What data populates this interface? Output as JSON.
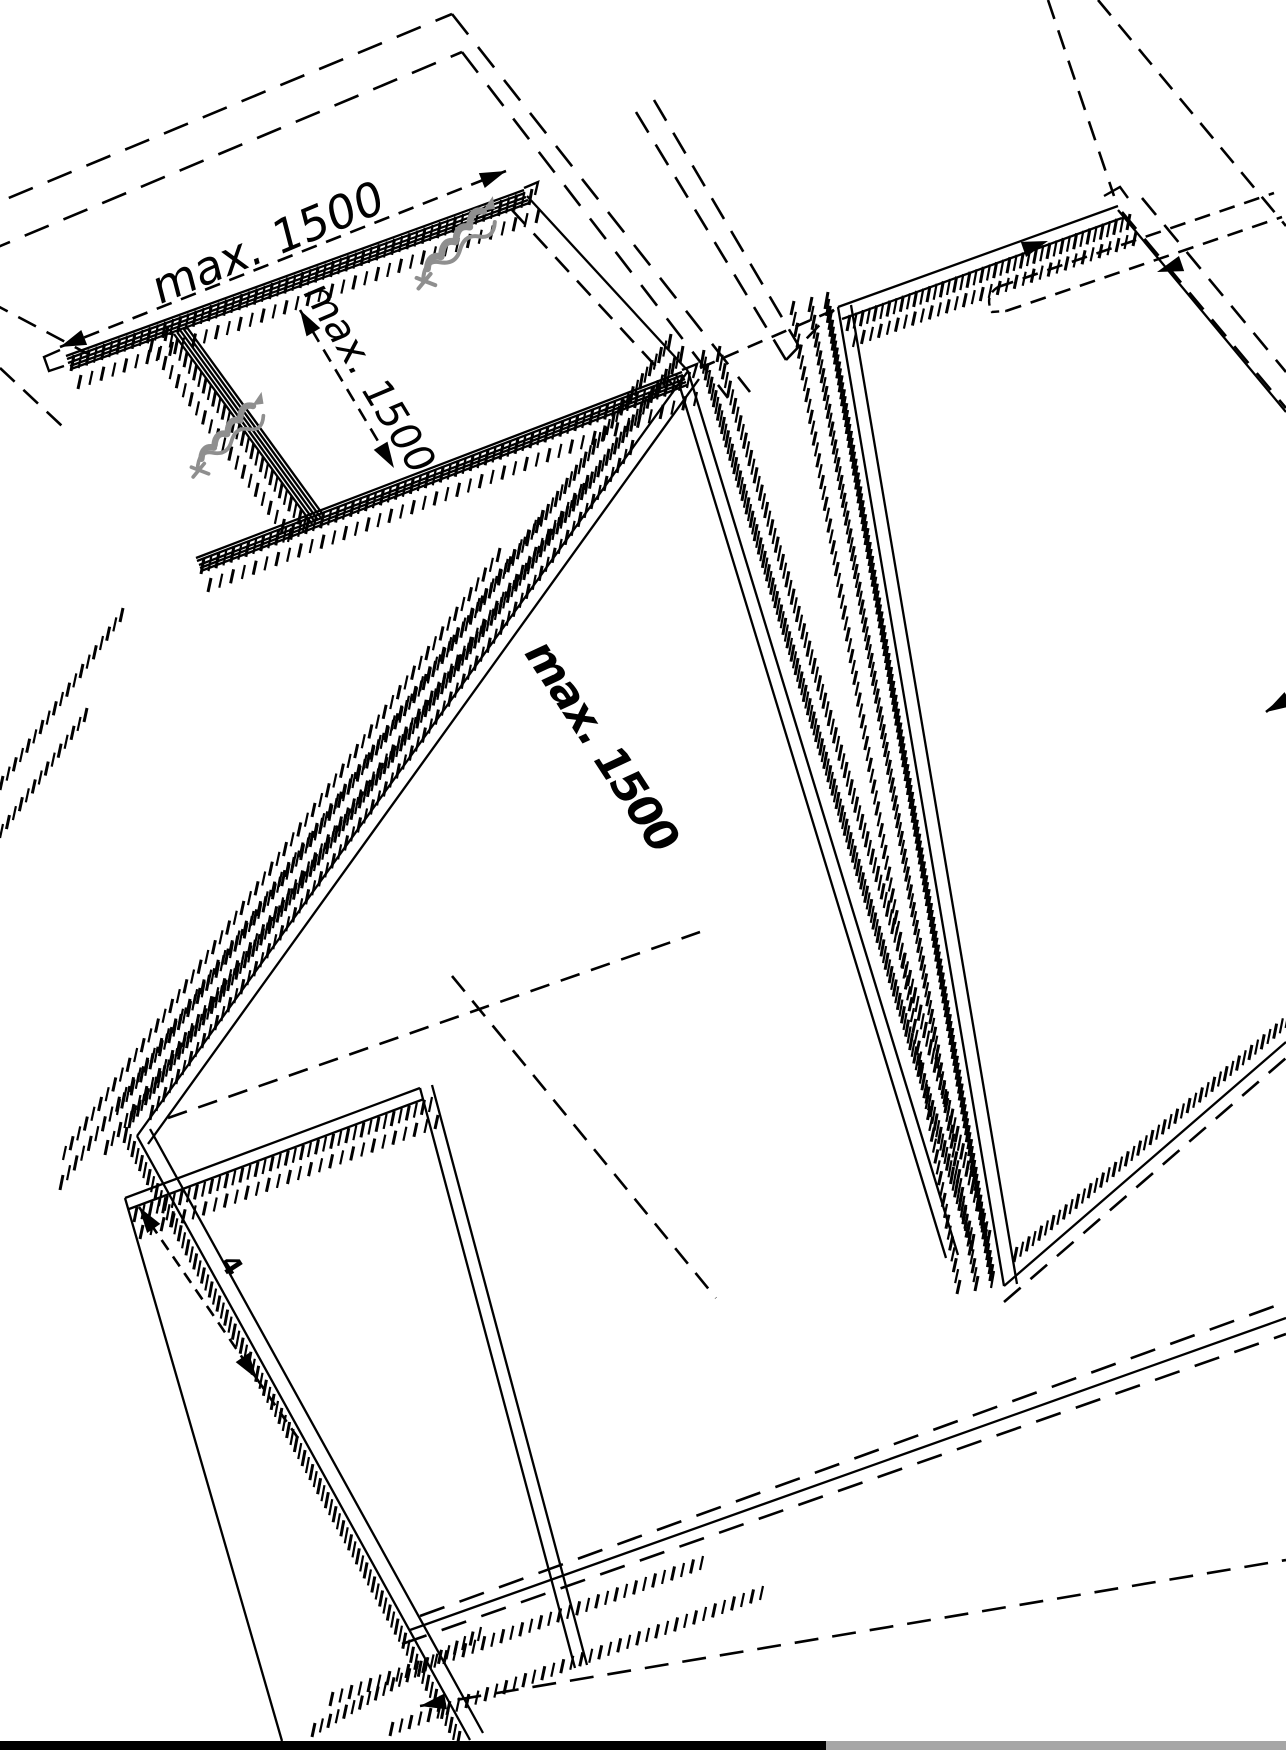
{
  "diagram": {
    "type": "isometric-installation-drawing",
    "labels": {
      "dim_top": "max. 1500",
      "dim_side": "max. 1500",
      "dim_center": "max. 1500",
      "dim_small": "4"
    },
    "icons": {
      "screw_1": "screw-icon",
      "screw_2": "screw-icon"
    },
    "colors": {
      "background": "#ffffff",
      "line": "#000000",
      "screw": "#8f8f8f",
      "bottom_bar_left": "#000000",
      "bottom_bar_right": "#a6a6a6"
    }
  }
}
